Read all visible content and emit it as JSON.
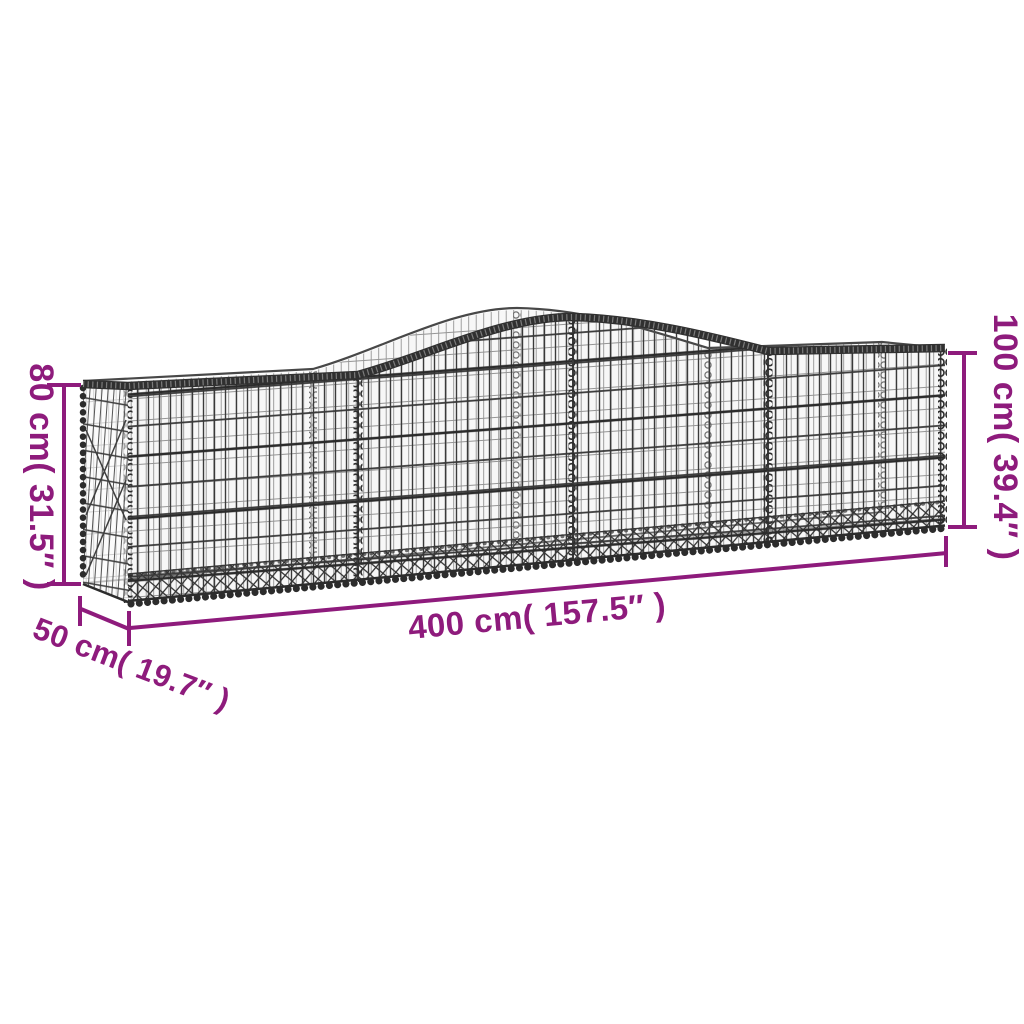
{
  "diagram": {
    "description": "Arched gabion basket made of galvanized iron wire mesh, shown in perspective with dimension annotations",
    "labels": {
      "height_left": "80 cm( 31.5″ )",
      "height_right": "100 cm( 39.4″ )",
      "length": "400 cm( 157.5″ )",
      "depth": "50 cm( 19.7″ )"
    },
    "dimensions": {
      "height_left_cm": "80",
      "height_left_in": "31.5",
      "height_right_cm": "100",
      "height_right_in": "39.4",
      "length_cm": "400",
      "length_in": "157.5",
      "depth_cm": "50",
      "depth_in": "19.7"
    },
    "colors": {
      "dimension_annotation": "#8e1b7c",
      "wire_dark": "#2c2c2c",
      "wire_mid": "#3a3a3a",
      "wire_light": "#8a8a8a",
      "background": "#ffffff"
    }
  }
}
